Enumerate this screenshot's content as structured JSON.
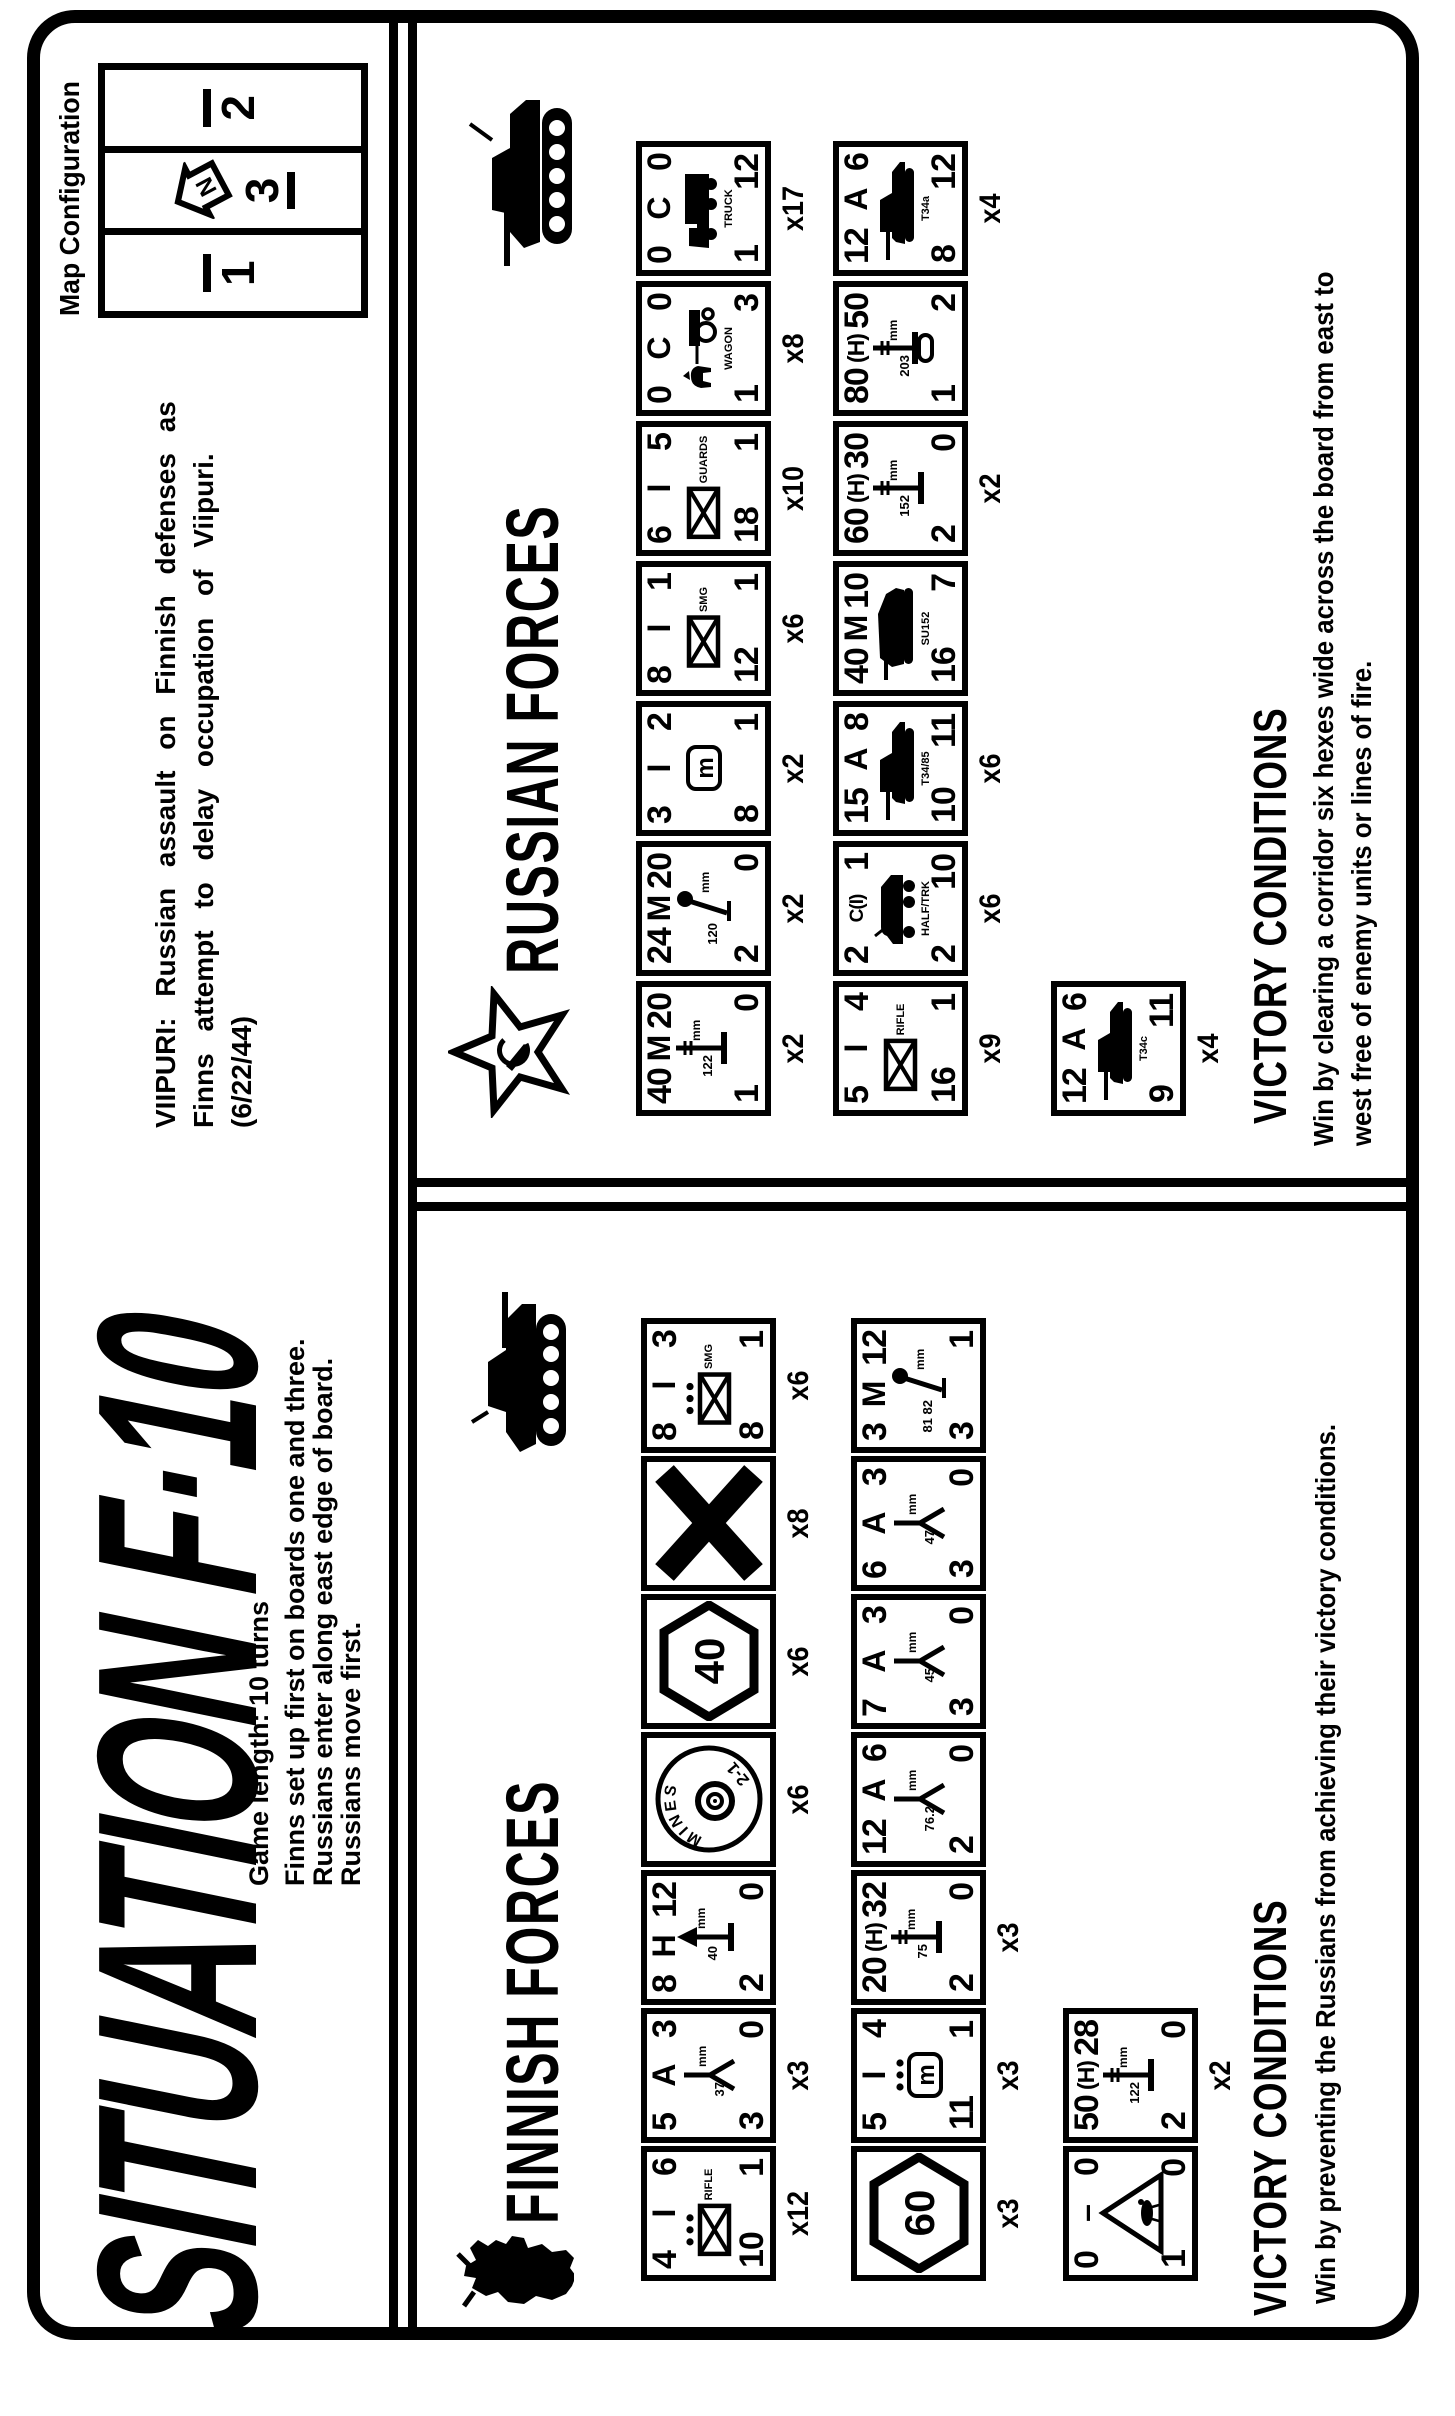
{
  "header": {
    "title": "SITUATION F·10",
    "viipuri_line1": "VIIPURI: Russian assault on Finnish defenses as",
    "viipuri_line2": "Finns attempt to delay occupation of Viipuri.",
    "viipuri_line3": "(6/22/44)",
    "game_info": [
      "Game length:  10 turns",
      "Finns set up first on boards one and three.",
      "Russians enter along east edge of board.",
      "Russians move first."
    ],
    "map_config": {
      "label": "Map Configuration",
      "compass_letter": "N",
      "boards": [
        {
          "num": "1",
          "bar": "over",
          "arrow": false
        },
        {
          "num": "3",
          "bar": "under",
          "arrow": true
        },
        {
          "num": "2",
          "bar": "over",
          "arrow": false
        }
      ]
    }
  },
  "symbols": {
    "mbox_letter": "m",
    "mm_label": "mm",
    "mines_label": "MINES",
    "mines_value": "2-1"
  },
  "finnish": {
    "heading": "FINNISH FORCES",
    "emblem": "finnish-lion",
    "victory_heading": "VICTORY CONDITIONS",
    "victory_line1": "Win by preventing the Russians from achieving their victory conditions.",
    "counters": [
      {
        "x": 135,
        "y": 641,
        "type": "unit",
        "top": [
          "4",
          "I",
          "6"
        ],
        "icon": "inf",
        "dots": true,
        "cap": "RIFLE",
        "bl": "10",
        "br": "1",
        "mult": "x12"
      },
      {
        "x": 273,
        "y": 641,
        "type": "unit",
        "top": [
          "5",
          "A",
          "3"
        ],
        "icon": "at",
        "cal": "37",
        "bl": "3",
        "br": "0",
        "mult": "x3"
      },
      {
        "x": 411,
        "y": 641,
        "type": "unit",
        "top": [
          "8",
          "H",
          "12"
        ],
        "icon": "aa",
        "cal": "40",
        "bl": "2",
        "br": "0"
      },
      {
        "x": 549,
        "y": 641,
        "type": "mines",
        "mult": "x6"
      },
      {
        "x": 687,
        "y": 641,
        "type": "hex",
        "hexnum": "40",
        "mult": "x6"
      },
      {
        "x": 825,
        "y": 641,
        "type": "x",
        "mult": "x8"
      },
      {
        "x": 963,
        "y": 641,
        "type": "unit",
        "top": [
          "8",
          "I",
          "3"
        ],
        "icon": "inf",
        "dots": true,
        "cap": "SMG",
        "bl": "8",
        "br": "1",
        "mult": "x6"
      },
      {
        "x": 135,
        "y": 851,
        "type": "hex",
        "hexnum": "60",
        "mult": "x3"
      },
      {
        "x": 273,
        "y": 851,
        "type": "unit",
        "top": [
          "5",
          "I",
          "4"
        ],
        "icon": "mbox",
        "dots": true,
        "bl": "11",
        "br": "1",
        "mult": "x3"
      },
      {
        "x": 411,
        "y": 851,
        "type": "unit",
        "top": [
          "20",
          "(H)",
          "32"
        ],
        "icon": "gun",
        "cal": "75",
        "bl": "2",
        "br": "0",
        "mult": "x3"
      },
      {
        "x": 549,
        "y": 851,
        "type": "unit",
        "top": [
          "12",
          "A",
          "6"
        ],
        "icon": "at",
        "cal": "76.2",
        "bl": "2",
        "br": "0"
      },
      {
        "x": 687,
        "y": 851,
        "type": "unit",
        "top": [
          "7",
          "A",
          "3"
        ],
        "icon": "at",
        "cal": "45",
        "bl": "3",
        "br": "0"
      },
      {
        "x": 825,
        "y": 851,
        "type": "unit",
        "top": [
          "6",
          "A",
          "3"
        ],
        "icon": "at",
        "cal": "47",
        "bl": "3",
        "br": "0"
      },
      {
        "x": 963,
        "y": 851,
        "type": "unit",
        "top": [
          "3",
          "M",
          "12"
        ],
        "icon": "mortar",
        "cal": "81 82",
        "bl": "3",
        "br": "1"
      },
      {
        "x": 135,
        "y": 1063,
        "type": "tri",
        "top": [
          "0",
          "–",
          "0"
        ],
        "bl": "1",
        "br": "0"
      },
      {
        "x": 273,
        "y": 1063,
        "type": "unit",
        "top": [
          "50",
          "(H)",
          "28"
        ],
        "icon": "gun",
        "cal": "122",
        "bl": "2",
        "br": "0",
        "mult": "x2"
      }
    ]
  },
  "russian": {
    "heading": "RUSSIAN FORCES",
    "emblem": "soviet-star",
    "victory_heading": "VICTORY CONDITIONS",
    "victory_line1": "Win by clearing a corridor six hexes wide across the board from east to",
    "victory_line2": "west free of enemy units or lines of fire.",
    "counters": [
      {
        "x": 1300,
        "y": 636,
        "type": "unit",
        "top": [
          "40",
          "M",
          "20"
        ],
        "icon": "gun",
        "cal": "122",
        "bl": "1",
        "br": "0",
        "mult": "x2"
      },
      {
        "x": 1440,
        "y": 636,
        "type": "unit",
        "top": [
          "24",
          "M",
          "20"
        ],
        "icon": "mortar",
        "cal": "120",
        "bl": "2",
        "br": "0",
        "mult": "x2"
      },
      {
        "x": 1580,
        "y": 636,
        "type": "unit",
        "top": [
          "3",
          "I",
          "2"
        ],
        "icon": "mbox",
        "dots": false,
        "bl": "8",
        "br": "1",
        "mult": "x2"
      },
      {
        "x": 1720,
        "y": 636,
        "type": "unit",
        "top": [
          "8",
          "I",
          "1"
        ],
        "icon": "inf",
        "dots": false,
        "cap": "SMG",
        "bl": "12",
        "br": "1",
        "mult": "x6"
      },
      {
        "x": 1860,
        "y": 636,
        "type": "unit",
        "top": [
          "6",
          "I",
          "5"
        ],
        "icon": "inf",
        "dots": false,
        "cap": "GUARDS",
        "bl": "18",
        "br": "1",
        "mult": "x10"
      },
      {
        "x": 2000,
        "y": 636,
        "type": "unit",
        "top": [
          "0",
          "C",
          "0"
        ],
        "icon": "wagon",
        "cap": "WAGON",
        "bl": "1",
        "br": "3",
        "mult": "x8"
      },
      {
        "x": 2140,
        "y": 636,
        "type": "unit",
        "top": [
          "0",
          "C",
          "0"
        ],
        "icon": "truck",
        "cap": "TRUCK",
        "bl": "1",
        "br": "12",
        "mult": "x17"
      },
      {
        "x": 1300,
        "y": 833,
        "type": "unit",
        "top": [
          "5",
          "I",
          "4"
        ],
        "icon": "inf",
        "dots": false,
        "cap": "RIFLE",
        "bl": "16",
        "br": "1",
        "mult": "x9"
      },
      {
        "x": 1440,
        "y": 833,
        "type": "unit",
        "top": [
          "2",
          "C(I)",
          "1"
        ],
        "icon": "car",
        "cap": "HALF/TRK",
        "bl": "2",
        "br": "10",
        "mult": "x6"
      },
      {
        "x": 1580,
        "y": 833,
        "type": "unit",
        "top": [
          "15",
          "A",
          "8"
        ],
        "icon": "tank",
        "cap": "T34/85",
        "bl": "10",
        "br": "11",
        "mult": "x6"
      },
      {
        "x": 1720,
        "y": 833,
        "type": "unit",
        "top": [
          "40",
          "M",
          "10"
        ],
        "icon": "td",
        "cap": "SU152",
        "bl": "16",
        "br": "7"
      },
      {
        "x": 1860,
        "y": 833,
        "type": "unit",
        "top": [
          "60",
          "(H)",
          "30"
        ],
        "icon": "gun",
        "cal": "152",
        "bl": "2",
        "br": "0",
        "mult": "x2"
      },
      {
        "x": 2000,
        "y": 833,
        "type": "unit",
        "top": [
          "80",
          "(H)",
          "50"
        ],
        "icon": "gun2",
        "cal": "203",
        "bl": "1",
        "br": "2"
      },
      {
        "x": 2140,
        "y": 833,
        "type": "unit",
        "top": [
          "12",
          "A",
          "6"
        ],
        "icon": "tank",
        "cap": "T34a",
        "bl": "8",
        "br": "12",
        "mult": "x4"
      },
      {
        "x": 1300,
        "y": 1051,
        "type": "unit",
        "top": [
          "12",
          "A",
          "6"
        ],
        "icon": "tank",
        "cap": "T34c",
        "bl": "9",
        "br": "11",
        "mult": "x4"
      }
    ]
  }
}
